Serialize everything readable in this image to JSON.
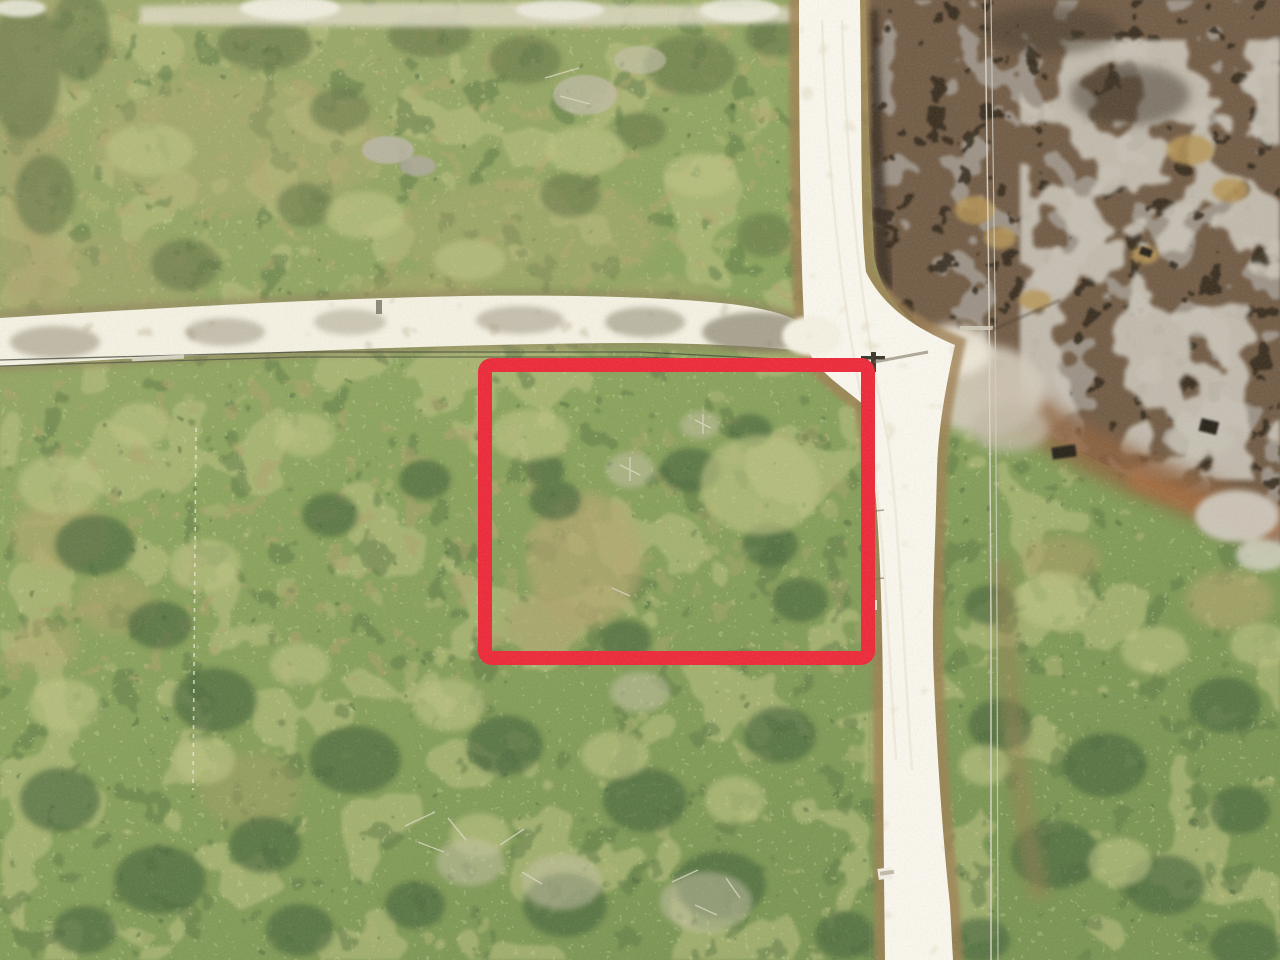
{
  "photo": {
    "kind": "aerial-drone-photograph",
    "subject": "vacant wooded land parcel outlined in red beside a white sand road junction with burned scrubland in the upper right"
  },
  "parcel": {
    "label": "parcel-boundary-outline",
    "color": "#ee1e2e",
    "x": 485,
    "y": 365,
    "width": 383,
    "height": 293,
    "stroke_width": 14,
    "corner_radius": 7
  },
  "colors": {
    "road": "#fbf8ee",
    "side_road": "#f6f2e2",
    "road_shoulder": "#9a7a4c",
    "burn_base": "#6b543c",
    "burn_char": "#251b11",
    "burn_ash": "#9d9488",
    "burn_ash_light": "#c9c3b5",
    "burn_rust": "#8a5c35",
    "veg_base_light": "#9aa565",
    "veg_base_dark": "#74904a",
    "veg_patch_light": "#b9bf7a",
    "veg_patch_dark": "#55713a",
    "dry_grass": "#b3a468",
    "power_line_light": "#d9d5c6",
    "power_line_dark": "#3f4434",
    "survey_line": "#e9e5d3",
    "sign_white": "#f2efe4"
  },
  "features": {
    "main_road": "white sand road running top to bottom",
    "side_road": "white sand road joining from the left",
    "top_path": "sand track along the top edge",
    "burned_area": "charred and ash-covered scrub, upper right",
    "rust_band": "scorched rust-coloured fringe along burn edge",
    "power_lines": "utility lines along both roads",
    "survey_line": "faint cleared survey line, left of parcel",
    "road_marker": "small white marker on road shoulder"
  }
}
